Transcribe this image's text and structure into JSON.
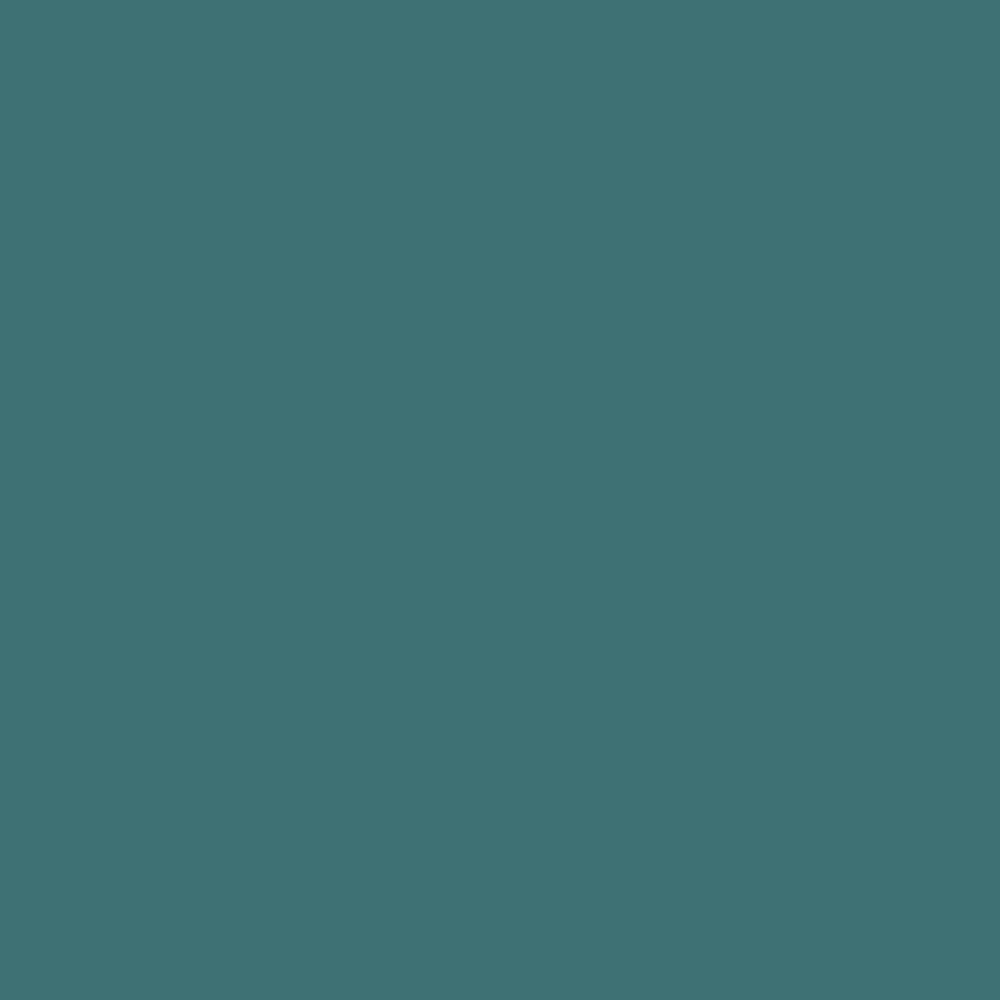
{
  "canvas": {
    "background_color": "#3E7174"
  }
}
